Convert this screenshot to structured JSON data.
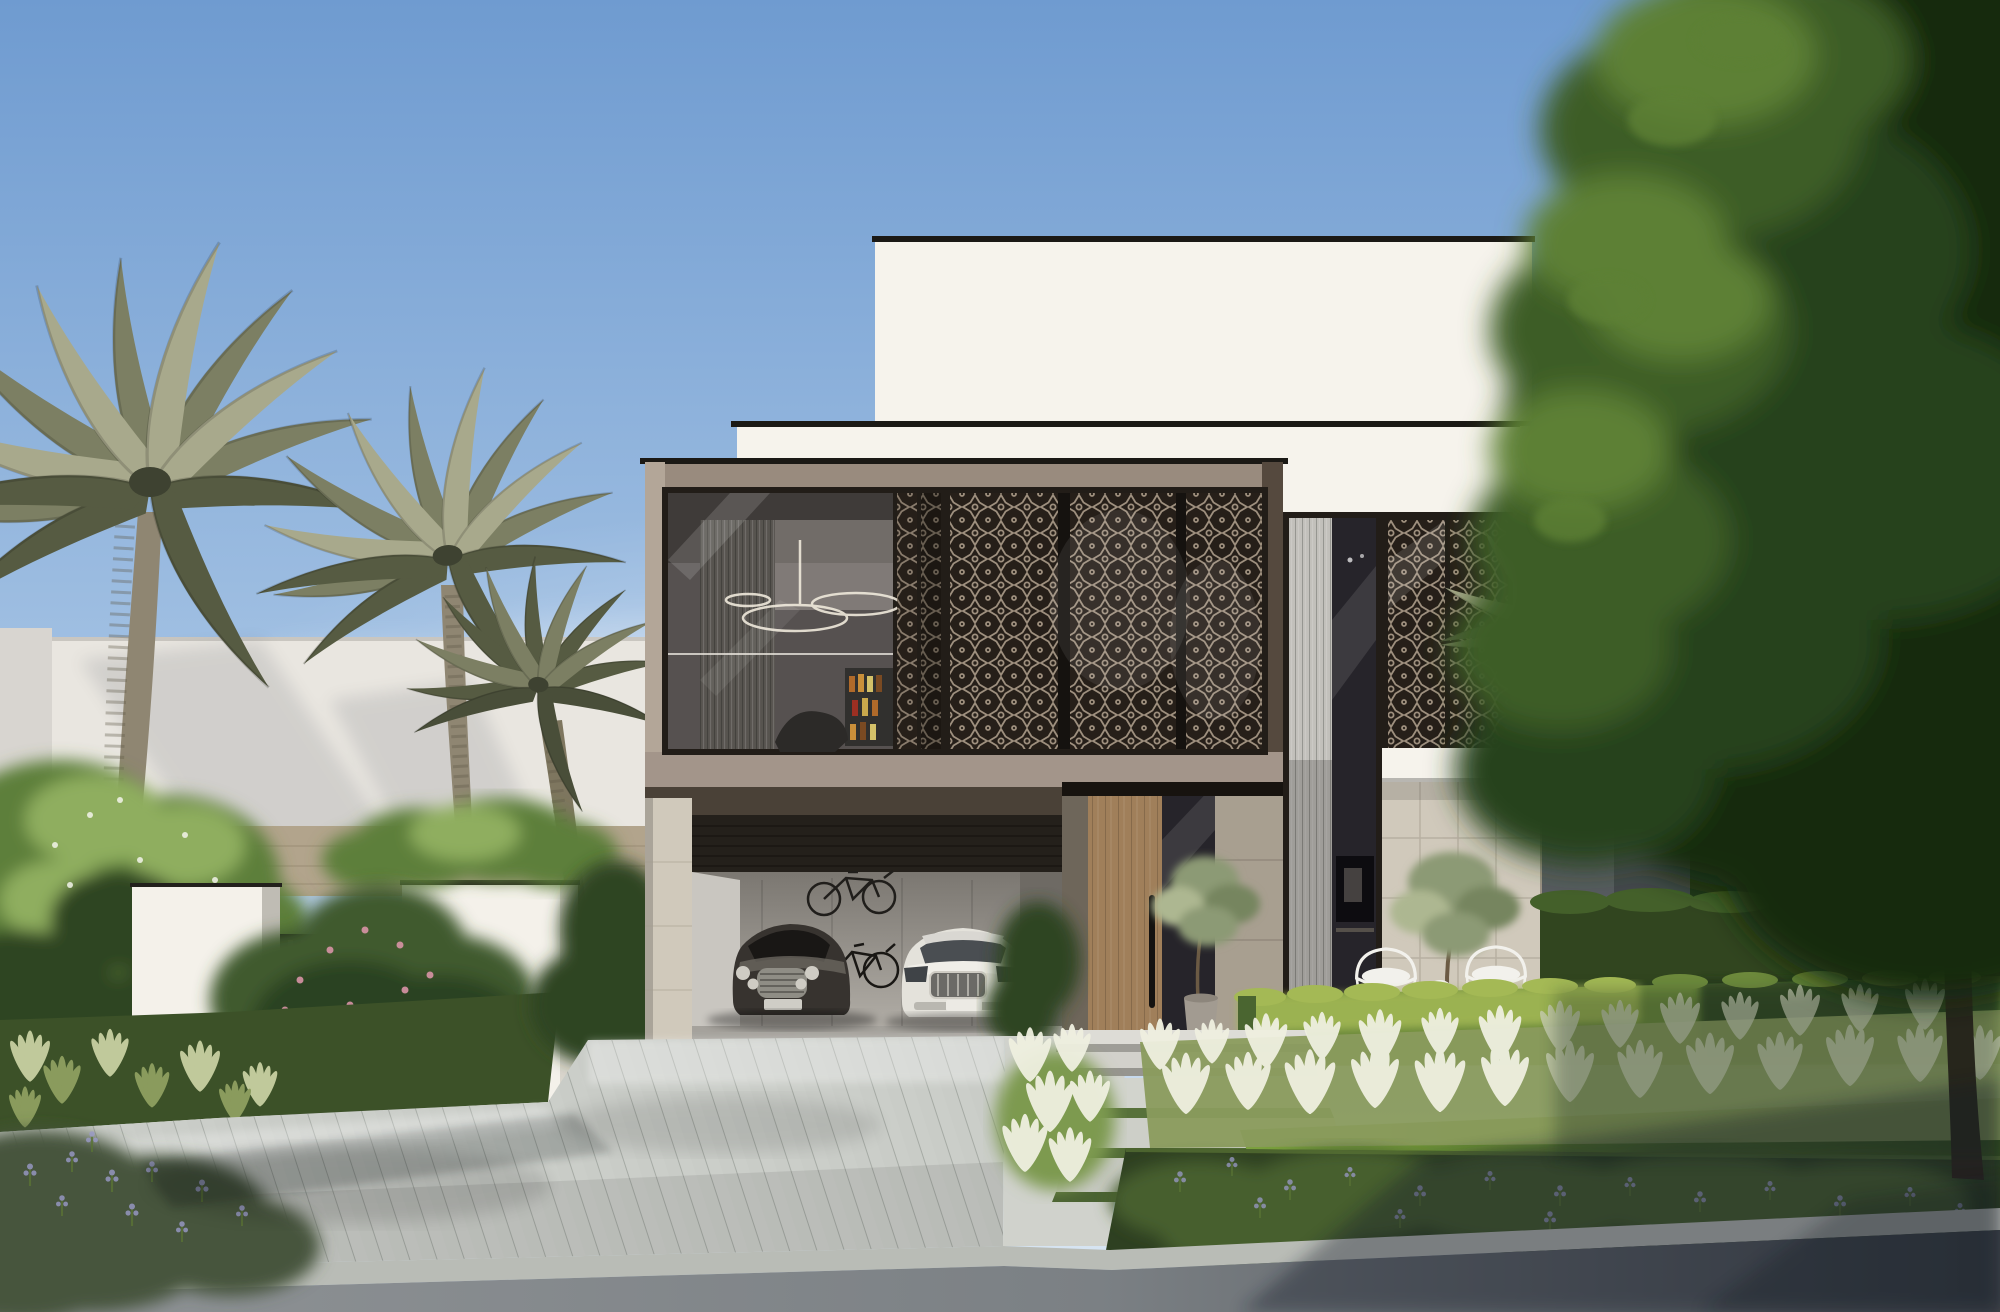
{
  "meta": {
    "kind": "3d-architectural-exterior-rendering",
    "subject": "Contemporary two-storey luxury villa, clear daytime sky",
    "canvas_width": 2000,
    "canvas_height": 1312,
    "visible_text": "none"
  },
  "palette": {
    "sky_top": "#6f9bd0",
    "sky_mid": "#a5c3e4",
    "sky_horizon": "#dce8f3",
    "cloud": "#ffffff",
    "white_wall": "#f6f3ec",
    "white_wall_shade": "#e1ddd3",
    "coping_dark": "#1b1915",
    "bronze_light": "#b3a698",
    "bronze_mid": "#998b7e",
    "bronze_dark": "#55493e",
    "bronze_soffit": "#a3958a",
    "frame_dark": "#221d18",
    "glass_dark": "#3a3d40",
    "glass_deep": "#26242a",
    "interior_wall": "#8b857e",
    "louver_light": "#c2c0bb",
    "mash_bg": "#261f19",
    "mash_light": "#c2b29c",
    "stone_light": "#d0c9bb",
    "stone_joint": "#a79f90",
    "wood_door": "#a07f5a",
    "door_handle": "#141210",
    "garage_wall": "#b5b1aa",
    "garage_ceiling": "#17140f",
    "roller_dark": "#24201b",
    "car_dark_body": "#37332f",
    "car_dark_glass": "#191715",
    "chrome": "#cfccc4",
    "car_white_body": "#e4e2db",
    "car_white_shade": "#b9b7b0",
    "bike_frame": "#201e1b",
    "driveway_plank": "#c9ccc7",
    "plank_joint": "#9fa49e",
    "apron_concrete": "#d0d2cc",
    "road_light": "#8f9396",
    "road_dark": "#42474d",
    "curb": "#b9bcb6",
    "lawn_sun": "#7da33f",
    "lawn_shade": "#37511f",
    "hedge_sun": "#a4b955",
    "hedge_mid": "#6d8a3c",
    "hedge_shade": "#24361b",
    "tall_hedge": "#31451f",
    "plume_white": "#eff0e0",
    "plume_green": "#8a9b5d",
    "groundcover_dark": "#2e4021",
    "groundcover_mid": "#465e2e",
    "lavender": "#9a9ac8",
    "palm_light": "#a8a98c",
    "palm_mid": "#7c7f63",
    "palm_dark": "#565b42",
    "palm_center": "#3e4231",
    "palm_trunk": "#8f8672",
    "trunk_ring": "#5f5949",
    "tree_light": "#5d8034",
    "tree_mid": "#3c5d26",
    "tree_dark": "#27421b",
    "tree_deep": "#182c10",
    "tree_trunk": "#2f261c",
    "neighbor_wall": "#e9e6e0",
    "tan_wall": "#b2a48c",
    "gate_white": "#f4f1ea",
    "gate_side": "#d9d5cc",
    "gate_dark": "#131211",
    "gate_slat": "#34312c",
    "flower_pink": "#d894a6",
    "foliage_bright": "#8fae5f",
    "foliage_base": "#5d7f3b",
    "foliage_deep": "#2f4522",
    "pot": "#a29b91",
    "olive_leaf": "#8c9a74",
    "olive_light": "#adb791",
    "chair_white": "#f2f1ec",
    "fence_grey": "#565b5e",
    "shadow": "#101418"
  },
  "scene": {
    "sky": {
      "condition": "clear blue, faint wispy clouds upper right and hazy glow at horizon"
    },
    "villa": {
      "storeys": 2,
      "features": [
        "stacked white render volumes with dark roof copings",
        "bronze-framed first-floor window box",
        "geometric mashrabiya lattice screens",
        "double-height glazed slot with louvered sheers",
        "travertine stone cladding at ground floor",
        "open double garage",
        "tall timber pivot entrance door with long black pull handle",
        "interior glimpses: ring chandelier, bottle shelf, lounge chair, wall TV"
      ]
    },
    "vehicles": [
      {
        "name": "dark-luxury-coupe"
      },
      {
        "name": "white-luxury-sedan"
      }
    ],
    "bicycles": [
      {
        "name": "wall-mounted-bicycle"
      },
      {
        "name": "freestanding-bicycle"
      }
    ],
    "furniture": [
      "two white wireframe outdoor chairs",
      "round side table"
    ],
    "landscape": [
      "three date palms on the left",
      "partial palm behind right wing",
      "large overhanging green tree on the right",
      "clipped hedge rows",
      "white plume ornamental grasses",
      "dark groundcover bed with lavender spikes",
      "rose shrubs with pink blooms by the gate",
      "frangipani shrubs far left",
      "olive trees (one potted at the door, one on the terrace)",
      "roof planter hedge above gate wall"
    ],
    "hardscape": [
      "diagonal timber-plank driveway",
      "smooth concrete apron and stone stepping path with grass joints",
      "two shallow entry steps",
      "white gate volumes with black vertical-slat pedestrian gate",
      "light concrete curb",
      "asphalt road in foreground with tree shadow"
    ]
  }
}
